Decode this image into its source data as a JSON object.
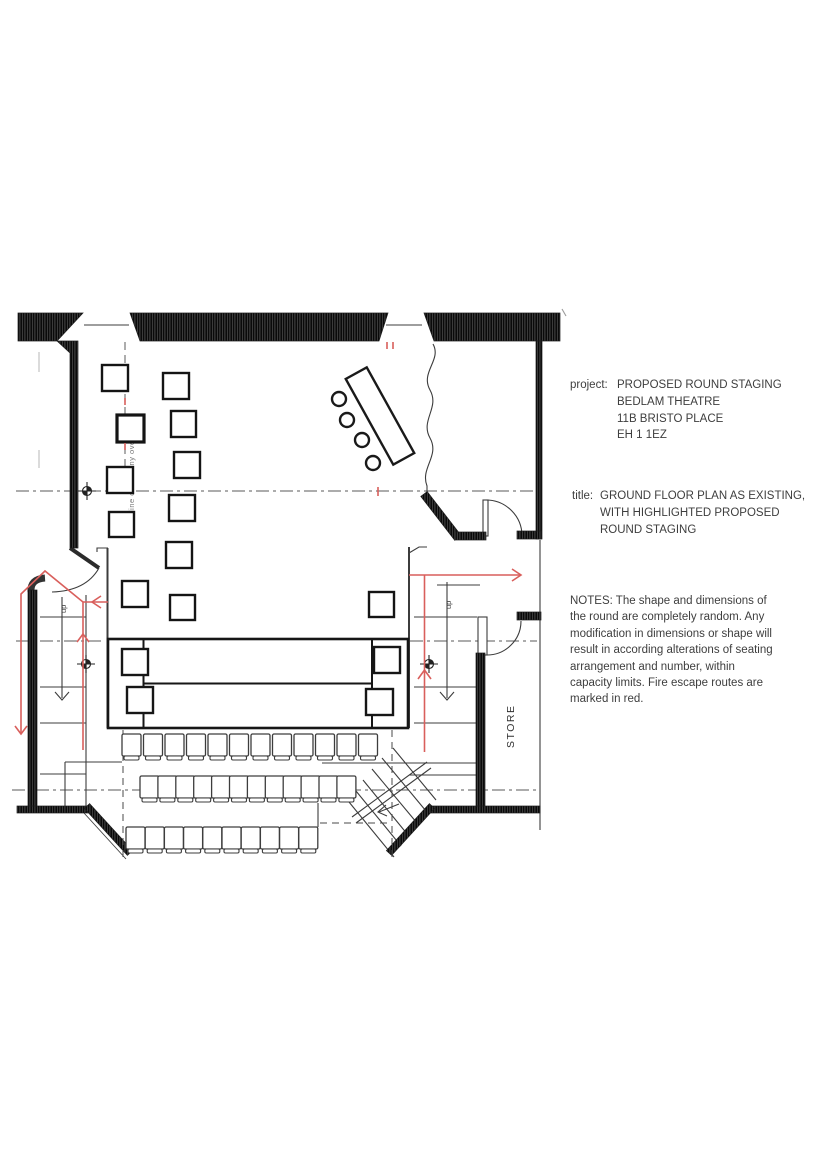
{
  "annotations": {
    "project": {
      "label": "project:",
      "lines": [
        "PROPOSED ROUND STAGING",
        "BEDLAM THEATRE",
        "11B BRISTO PLACE",
        "EH 1 1EZ"
      ]
    },
    "title": {
      "label": "title:",
      "lines": [
        "GROUND FLOOR PLAN AS EXISTING,",
        "WITH HIGHLIGHTED PROPOSED",
        "ROUND STAGING"
      ]
    },
    "notes": {
      "lines": [
        "NOTES: The shape and dimensions of",
        "the round are completely random. Any",
        "modification in dimensions or shape will",
        "result in according alterations of seating",
        "arrangement and number, within",
        "capacity limits. Fire escape routes are",
        "marked in red."
      ]
    }
  },
  "plan": {
    "labels": {
      "up_left": "up",
      "up_right": "up",
      "store": "STORE",
      "balcony_line": "line of balcony over"
    },
    "colors": {
      "escape_route": "#d95f5c",
      "wall": "#3f3f3f",
      "drawing_line": "#2e2e2e",
      "centerline": "#5a5a5a"
    },
    "features": {
      "hall_squares": 12,
      "stage_corner_squares": 4,
      "desk_stools": 4,
      "seating_row_counts": [
        12,
        12,
        10
      ],
      "survey_markers": 3,
      "escape_route_arrows": 5
    }
  }
}
